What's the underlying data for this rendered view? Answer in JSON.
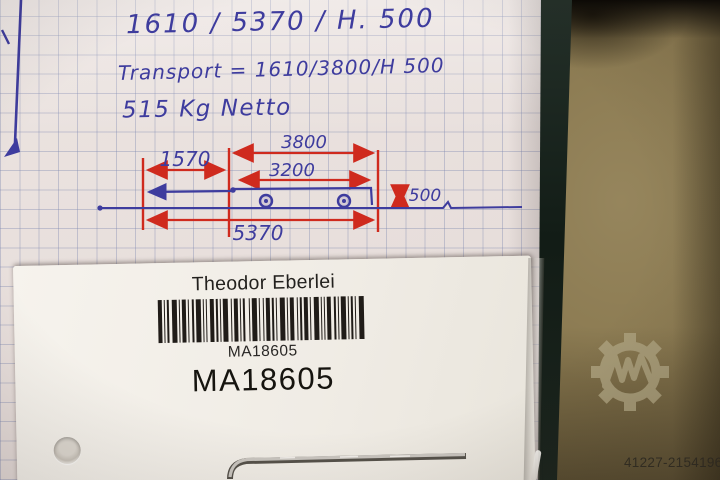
{
  "photo_alt": "Handwritten trailer dimension note on graph paper with vendor barcode label",
  "note": {
    "line1": "1610 / 5370 / H. 500",
    "line2": "Transport = 1610/3800/H 500",
    "line3": "515 Kg Netto"
  },
  "sketch": {
    "dim_top": "3800",
    "dim_inner": "3200",
    "dim_left": "1570",
    "dim_bottom": "5370",
    "dim_height": "500"
  },
  "label": {
    "vendor": "Theodor Eberlei",
    "barcode_caption": "MA18605",
    "item_code": "MA18605",
    "barcode_pattern": [
      4,
      2,
      1,
      2,
      2,
      3,
      5,
      2,
      1,
      2,
      4,
      2,
      1,
      3,
      2,
      2,
      5,
      2,
      1,
      2,
      1,
      3,
      4,
      2,
      2,
      2,
      1,
      2,
      5,
      3,
      1,
      2,
      4,
      2,
      1,
      2,
      2,
      4,
      1,
      2,
      5,
      2,
      1,
      3,
      1,
      2,
      4,
      2,
      2,
      2,
      1,
      3,
      5,
      2,
      1,
      2,
      4,
      3,
      1,
      2,
      2,
      2,
      4,
      2,
      1,
      3,
      5,
      2,
      1,
      2,
      1,
      2,
      4,
      3,
      2,
      2,
      1,
      2,
      5,
      2,
      1,
      2,
      2,
      2,
      1,
      3,
      5
    ]
  },
  "watermark": {
    "listing_id": "41227-21541968",
    "logo_name": "machineseeker-gear-logo"
  },
  "colors": {
    "ink_blue": "#3e3c9e",
    "ink_red": "#cf2a1e",
    "paper": "#eae2df",
    "card_white": "#f3f0ea",
    "table_olive": "#8a7950",
    "strip_dark": "#1b241d"
  }
}
